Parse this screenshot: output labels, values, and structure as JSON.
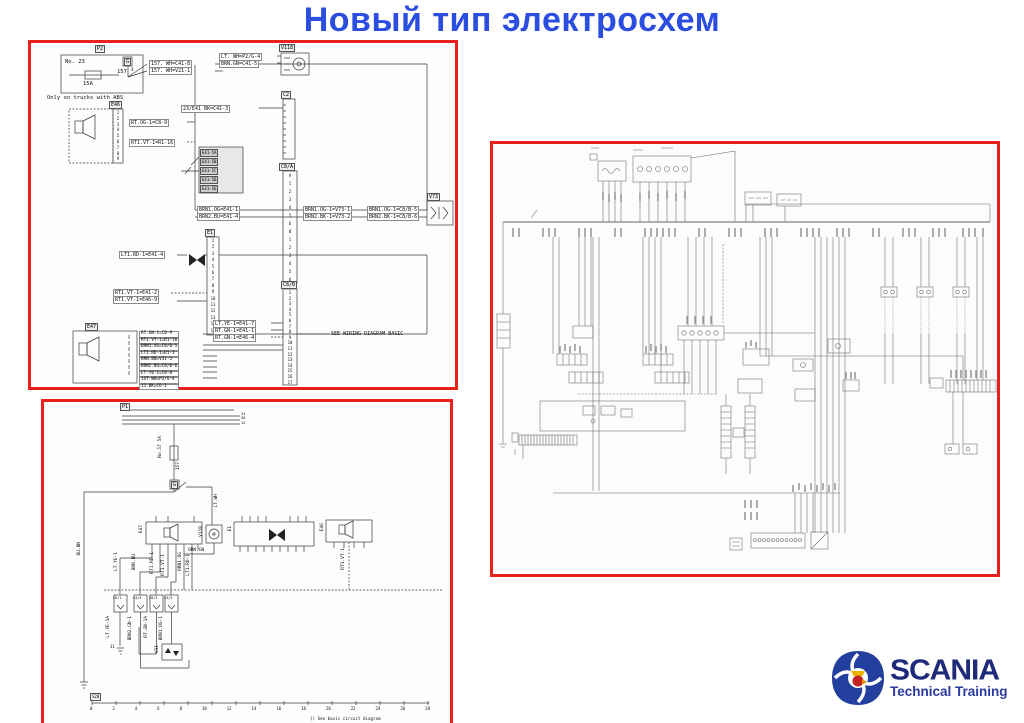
{
  "page": {
    "title": "Новый тип электросхем"
  },
  "logo": {
    "brand": "SCANIA",
    "subtitle": "Technical Training"
  },
  "box1": {
    "p2_label": "P2",
    "fuse_no": "No. 23",
    "fuse_circuit": "157",
    "fuse_rating": "15A",
    "g_label": "G",
    "g_pin": "4",
    "abs_note": "Only on trucks with ABS",
    "wire_157_a": "157. WH=C41-8",
    "wire_157_b": "157. WH=V21-1",
    "v118_label": "V118",
    "wire_ltwh": "LT. WH=P2/G-4",
    "wire_brngn": "BRN.GN=C41-5",
    "c2_label": "C2",
    "wire_23e41": "23/E41 BK=C41-3",
    "c8a_label": "C8/A",
    "c8a_pins": [
      "A",
      "1",
      "2",
      "3",
      "4",
      "5",
      "6",
      "B",
      "1",
      "2",
      "3",
      "4",
      "5",
      "6"
    ],
    "grid_rows": [
      "E41-5A",
      "E41-5B",
      "E41-5C",
      "E41-5D",
      "E41-5E"
    ],
    "e46_label": "E46",
    "e46_pins": [
      "1",
      "2",
      "3",
      "4",
      "5",
      "6",
      "7",
      "8",
      "9"
    ],
    "wire_rtog": "RT.OG-1=C8-9",
    "wire_rt1vt_r1": "RT1.VT-1=R1-16",
    "e1_label": "E1",
    "e1_pins": [
      "1",
      "2",
      "3",
      "4",
      "5",
      "6",
      "7",
      "8",
      "9",
      "10",
      "11",
      "12",
      "13",
      "14",
      "15"
    ],
    "wire_lt1rd": "LT1.RD-1=E41-4",
    "wire_rt1vt_e41": "RT1.VT-1=E41-2",
    "wire_rt1vt_e46": "RT1.VT-1=E46-9",
    "bus_left_1": "BRN1.OG=E41-1",
    "bus_left_2": "BRN2.BU=E41-4",
    "bus_mid_1": "BRN1.OG-1=V73-1",
    "bus_mid_2": "BRN2.BK-1=V73-2",
    "bus_right_1": "BRN1.OG-1=C8/B-5",
    "bus_right_2": "BRN2.BK-1=C8/B-6",
    "v73_label": "V73",
    "c8b_label": "C8/B",
    "c8b_pins": [
      "1",
      "2",
      "3",
      "4",
      "5",
      "6",
      "7",
      "8",
      "9",
      "10",
      "11",
      "12",
      "13",
      "14",
      "15",
      "16",
      "17"
    ],
    "wire_ltye": "LT.YE-1=E41-7",
    "wire_rtgn_e41": "RT.GN-1=E41-1",
    "wire_rtgn_e46": "RT.GN-1=E46-4",
    "see_note": "SEE WIRING DIAGRAM BASIC",
    "e47_label": "E47",
    "e47_wires": [
      "RT.GN-1=C8-9",
      "RT1.VT-1=R1-16",
      "BRN1.OG=C8/B-5",
      "LT1.RD-1=R1-3",
      "BRN.BN=V31-3",
      "BRN2.BU=C8/B-6",
      "LT.YE-1=C8-8",
      "1ST.WH=P2/G-4",
      "11.BK=C6-1"
    ]
  },
  "box2": {
    "p1_label": "P1",
    "bus_terminals": [
      "31",
      "58",
      "15"
    ],
    "fuse_label": "No.17 5A",
    "wire_157": "157",
    "g_label": "G",
    "wire_ltwh": "LT.WH",
    "wire_bubn": "BU.BN",
    "e47_label": "E47",
    "v118_label": "V118",
    "e1_label": "E1",
    "e46_label": "E46",
    "wire_orngn": "ORN.GN",
    "wire_rt1vt": "RT1.VT-1",
    "drop_labels": [
      "LT.YE-1",
      "BRN.BU",
      "RT1.RD-1",
      "RT1.VT-1",
      "ORN1.OG",
      "LT1.RD-1"
    ],
    "conn_labels": [
      "C8/1",
      "C4/5",
      "C8/2",
      "C4/5"
    ],
    "conn_wires": [
      "LT.YE-1A",
      "BRN2.GN-1",
      "RT.GN-1A",
      "BRN1.OG-1"
    ],
    "v31_label": "V31",
    "gnd_label": "31",
    "ruler_tag": "S20",
    "ruler_ticks": [
      "0",
      "2",
      "4",
      "6",
      "8",
      "10",
      "12",
      "14",
      "16",
      "18",
      "20",
      "22",
      "24",
      "26",
      "28"
    ],
    "footnote": "() See basic circuit diagram"
  }
}
